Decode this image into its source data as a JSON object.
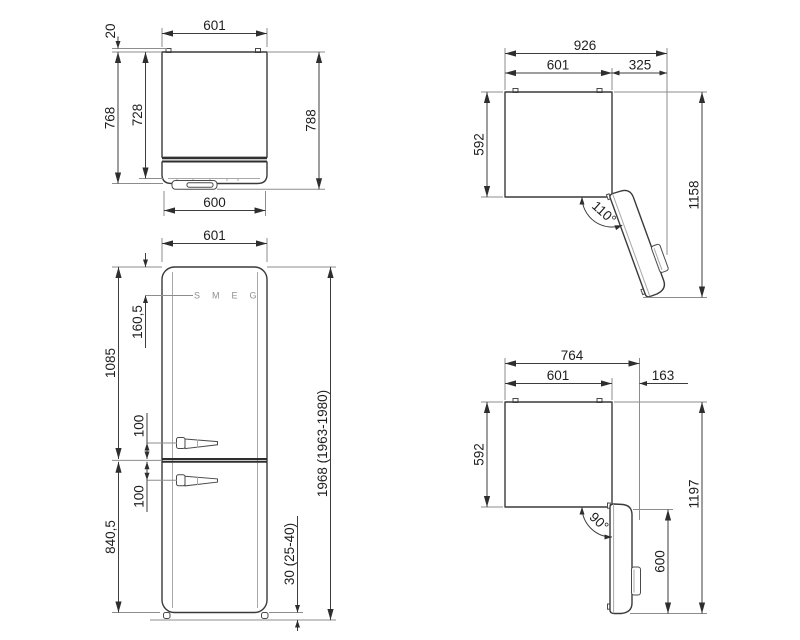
{
  "views": {
    "plan": {
      "w_top": "601",
      "spacer": "20",
      "depth_door": "768",
      "depth_body": "728",
      "depth_handle": "788",
      "w_door": "600"
    },
    "front": {
      "width": "601",
      "logo_offset": "160,5",
      "upper_section": "1085",
      "handle_upper": "100",
      "handle_lower": "100",
      "lower_section": "840,5",
      "total_height": "1968 (1963-1980)",
      "feet_height": "30 (25-40)",
      "logo": "SMEG"
    },
    "open110": {
      "total_width": "926",
      "body_width": "601",
      "door_swing": "325",
      "depth": "592",
      "total_depth": "1158",
      "angle": "110°"
    },
    "open90": {
      "total_width": "764",
      "body_width": "601",
      "door_swing": "163",
      "depth": "592",
      "total_depth": "1197",
      "door_length": "600",
      "angle": "90°"
    }
  }
}
